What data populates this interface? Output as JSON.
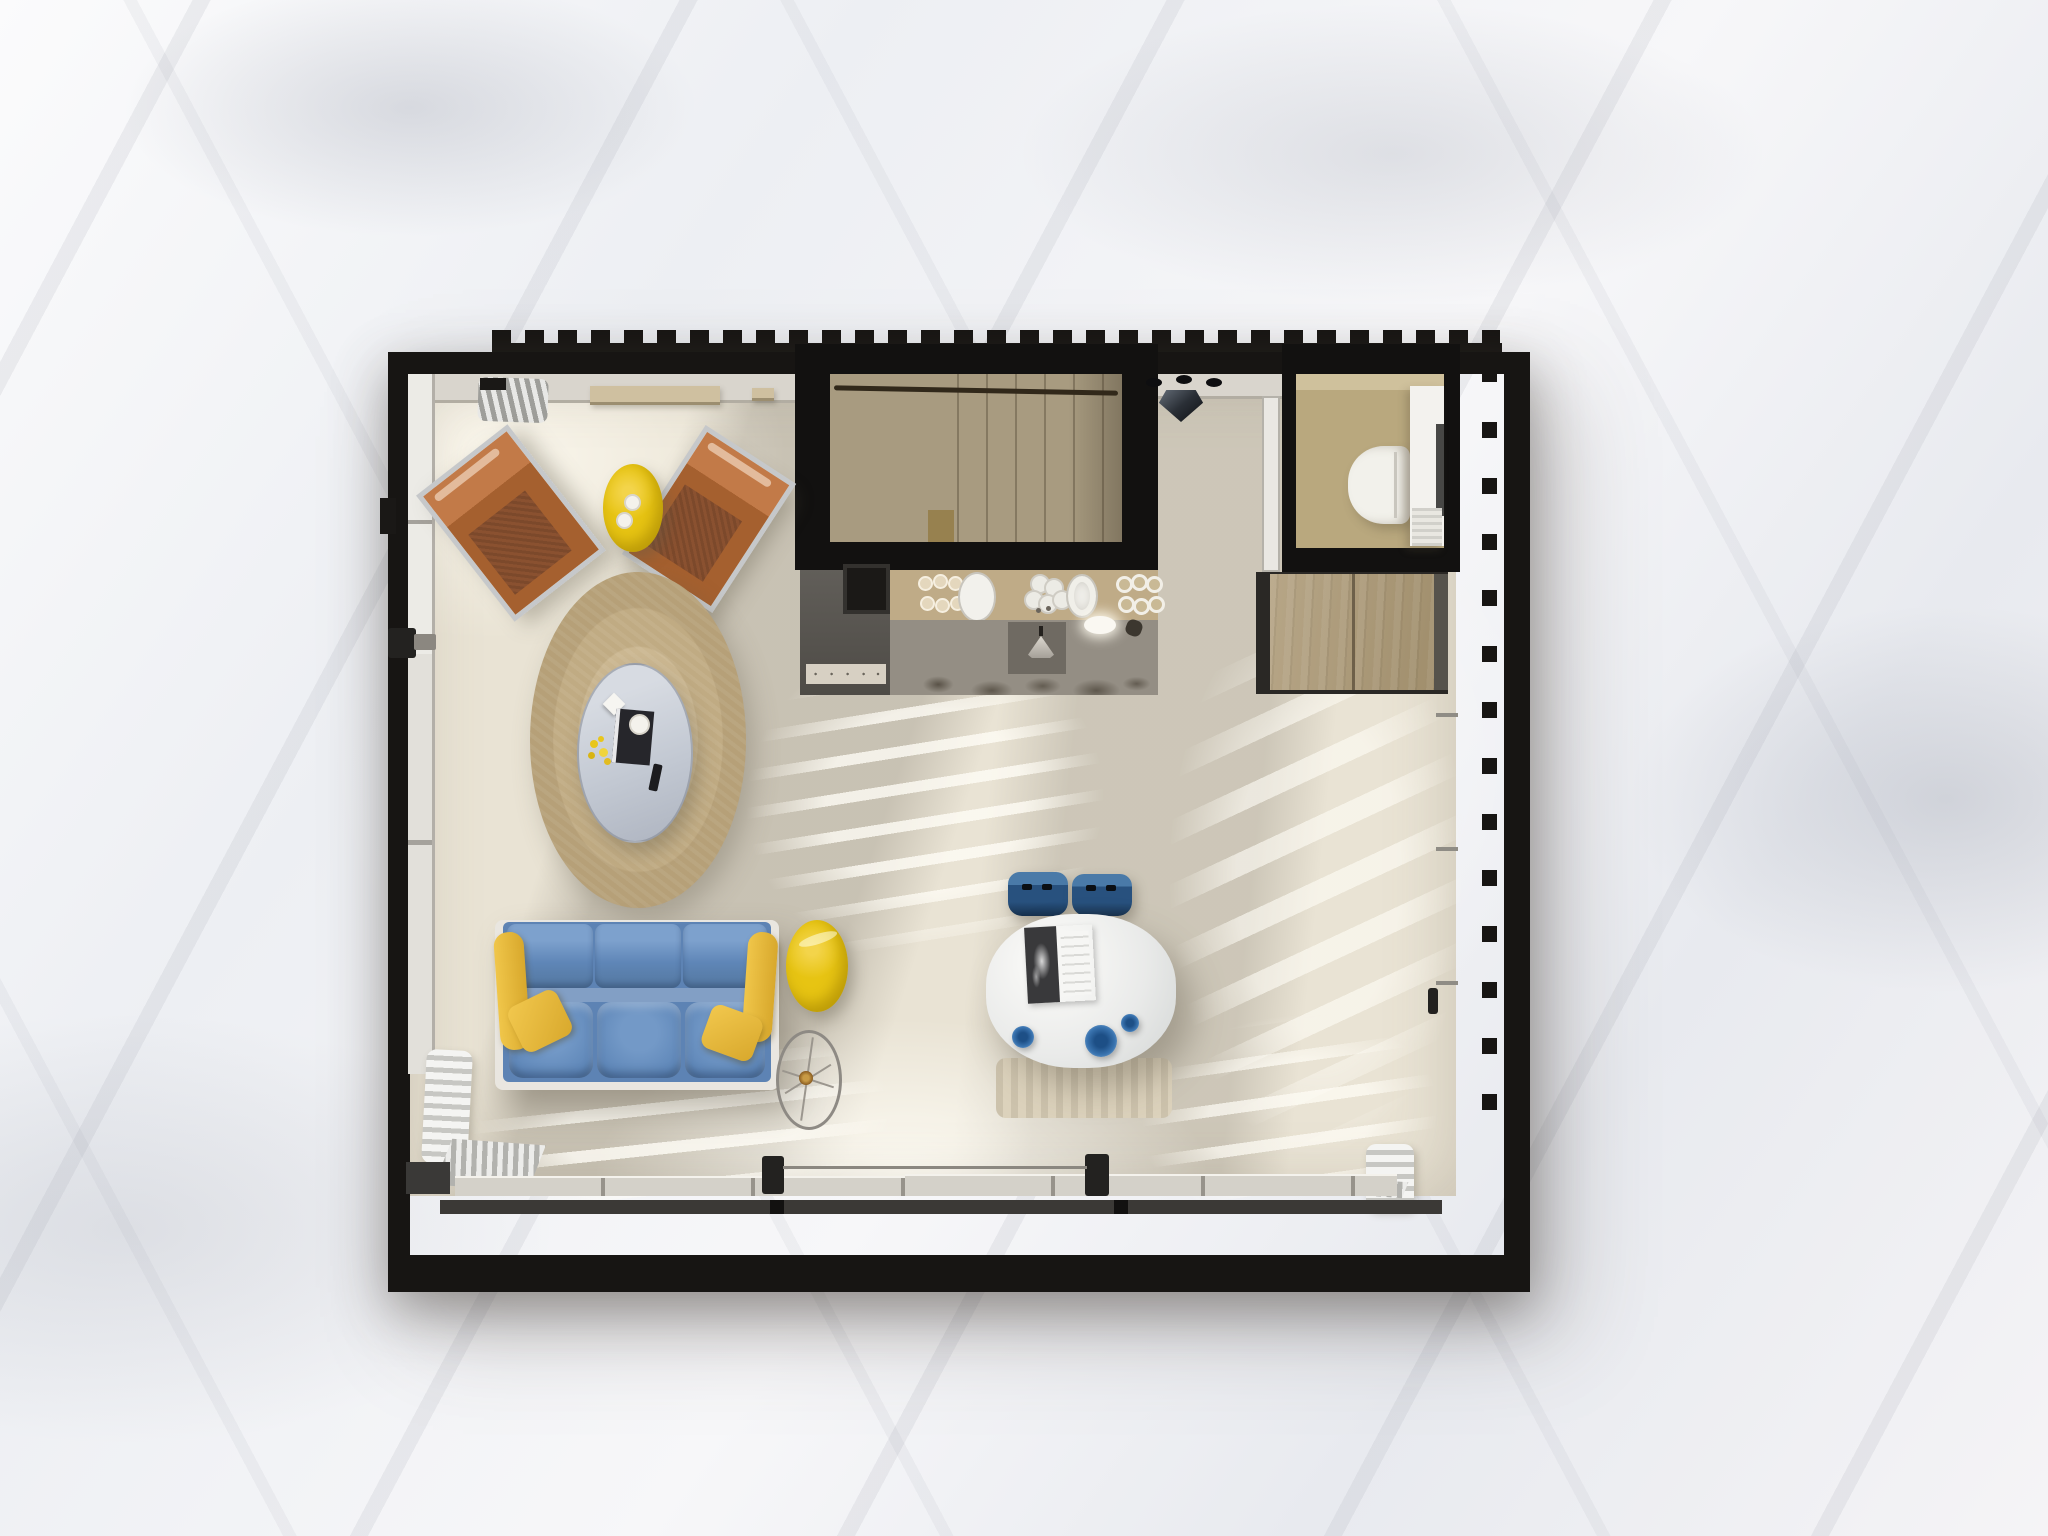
{
  "scene": {
    "title": "Studio apartment floor plan — top-down 3D render",
    "type": "3d-floor-plan-render",
    "background_surface": "white marble",
    "no_visible_text": true
  },
  "palette": {
    "marble": "#f3f2f4",
    "wall_black": "#171513",
    "floor_cream": "#e9e3d4",
    "sun_stripe": "#fffdf6",
    "stair_tan": "#a89b80",
    "counter_wood": "#bfab87",
    "kitchen_base_grey": "#948e84",
    "range_grey": "#55524e",
    "bathroom_floor_tan": "#b9a87e",
    "wardrobe_wood": "#ae9d80",
    "rug_tan": "#c4b08a",
    "coffee_table_grey": "#c9cfd8",
    "sofa_blue": "#5d83b4",
    "dining_chair_blue": "#28517e",
    "plate_blue": "#2e6aa5",
    "accent_yellow": "#e7c413",
    "pillow_yellow": "#e3b43a",
    "leather_copper": "#a5602f",
    "table_white": "#eeefed",
    "toilet_white": "#f2f1eb",
    "vanity_white": "#f3f2ee",
    "bench_beige": "#dcd2bc",
    "glazing_grey": "#d4d1c9"
  },
  "rooms": {
    "living_area": {
      "name": "living area"
    },
    "kitchen": {
      "name": "kitchenette"
    },
    "staircase": {
      "name": "winder staircase to upper floor"
    },
    "bathroom": {
      "name": "bathroom"
    },
    "wardrobe": {
      "name": "built-in wardrobe"
    },
    "dining_area": {
      "name": "dining area"
    },
    "hallway": {
      "name": "hallway by stairs"
    }
  },
  "furniture": {
    "lounge_chair_left": {
      "name": "copper leather lounge chair",
      "color": "#a5602f"
    },
    "lounge_chair_right": {
      "name": "copper leather lounge chair",
      "color": "#a5602f"
    },
    "side_table_yellow_top": {
      "name": "round yellow side table with two cups",
      "color": "#e7c413"
    },
    "round_rug": {
      "name": "round woven rug",
      "color": "#c4b08a"
    },
    "coffee_table": {
      "name": "round coffee table with book, flowers and remote",
      "color": "#c9cfd8"
    },
    "sofa": {
      "name": "three-seat blue sofa with yellow pillows",
      "color": "#5d83b4",
      "pillow_color": "#e3b43a",
      "seat_count": 3
    },
    "side_table_yellow_bottom": {
      "name": "round yellow side table",
      "color": "#e7c413"
    },
    "wire_side_table": {
      "name": "glass wire-spoke side table"
    },
    "dining_table": {
      "name": "white dining table with open magazine",
      "color": "#eeefed"
    },
    "dining_chair_count": 2,
    "dining_chair": {
      "name": "blue dining chair",
      "color": "#28517e"
    },
    "blue_plates": {
      "name": "blue plates on dining table",
      "count": 3,
      "color": "#2e6aa5"
    },
    "dining_bench": {
      "name": "beige bench under table",
      "color": "#dcd2bc"
    },
    "range_cooker": {
      "name": "range cooker with hood",
      "color": "#55524e"
    },
    "kitchen_counter": {
      "name": "wood counter with sinks, plates and glasses",
      "color": "#bfab87"
    },
    "pendant_lamp": {
      "name": "black faceted pendant lamp with three spots"
    },
    "toilet": {
      "name": "wall-hung toilet",
      "color": "#f2f1eb"
    },
    "vanity": {
      "name": "bathroom vanity cabinet",
      "color": "#f3f2ee"
    },
    "wardrobe_unit": {
      "name": "two-door plywood wardrobe",
      "color": "#ae9d80"
    },
    "radiators": {
      "name": "white ribbed radiators / decor stacks",
      "count": 3
    },
    "wall_shelf": {
      "name": "wood wall shelf"
    }
  }
}
